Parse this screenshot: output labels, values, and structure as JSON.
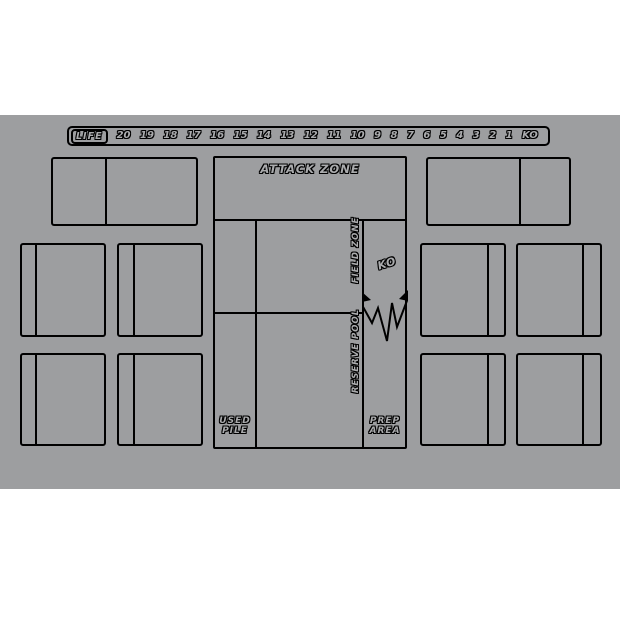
{
  "page": {
    "background_color": "#ffffff"
  },
  "mat": {
    "background_color": "#9d9ea0",
    "line_color": "#000000"
  },
  "life_track": {
    "label": "LIFE",
    "values": [
      "20",
      "19",
      "18",
      "17",
      "16",
      "15",
      "14",
      "13",
      "12",
      "11",
      "10",
      "9",
      "8",
      "7",
      "6",
      "5",
      "4",
      "3",
      "2",
      "1",
      "KO"
    ]
  },
  "zones": {
    "attack_zone": "ATTACK ZONE",
    "field_zone": "FIELD ZONE",
    "ko": "KO",
    "reserve_pool": "RESERVE POOL",
    "used_pile": "USED PILE",
    "prep_area": "PREP AREA"
  }
}
